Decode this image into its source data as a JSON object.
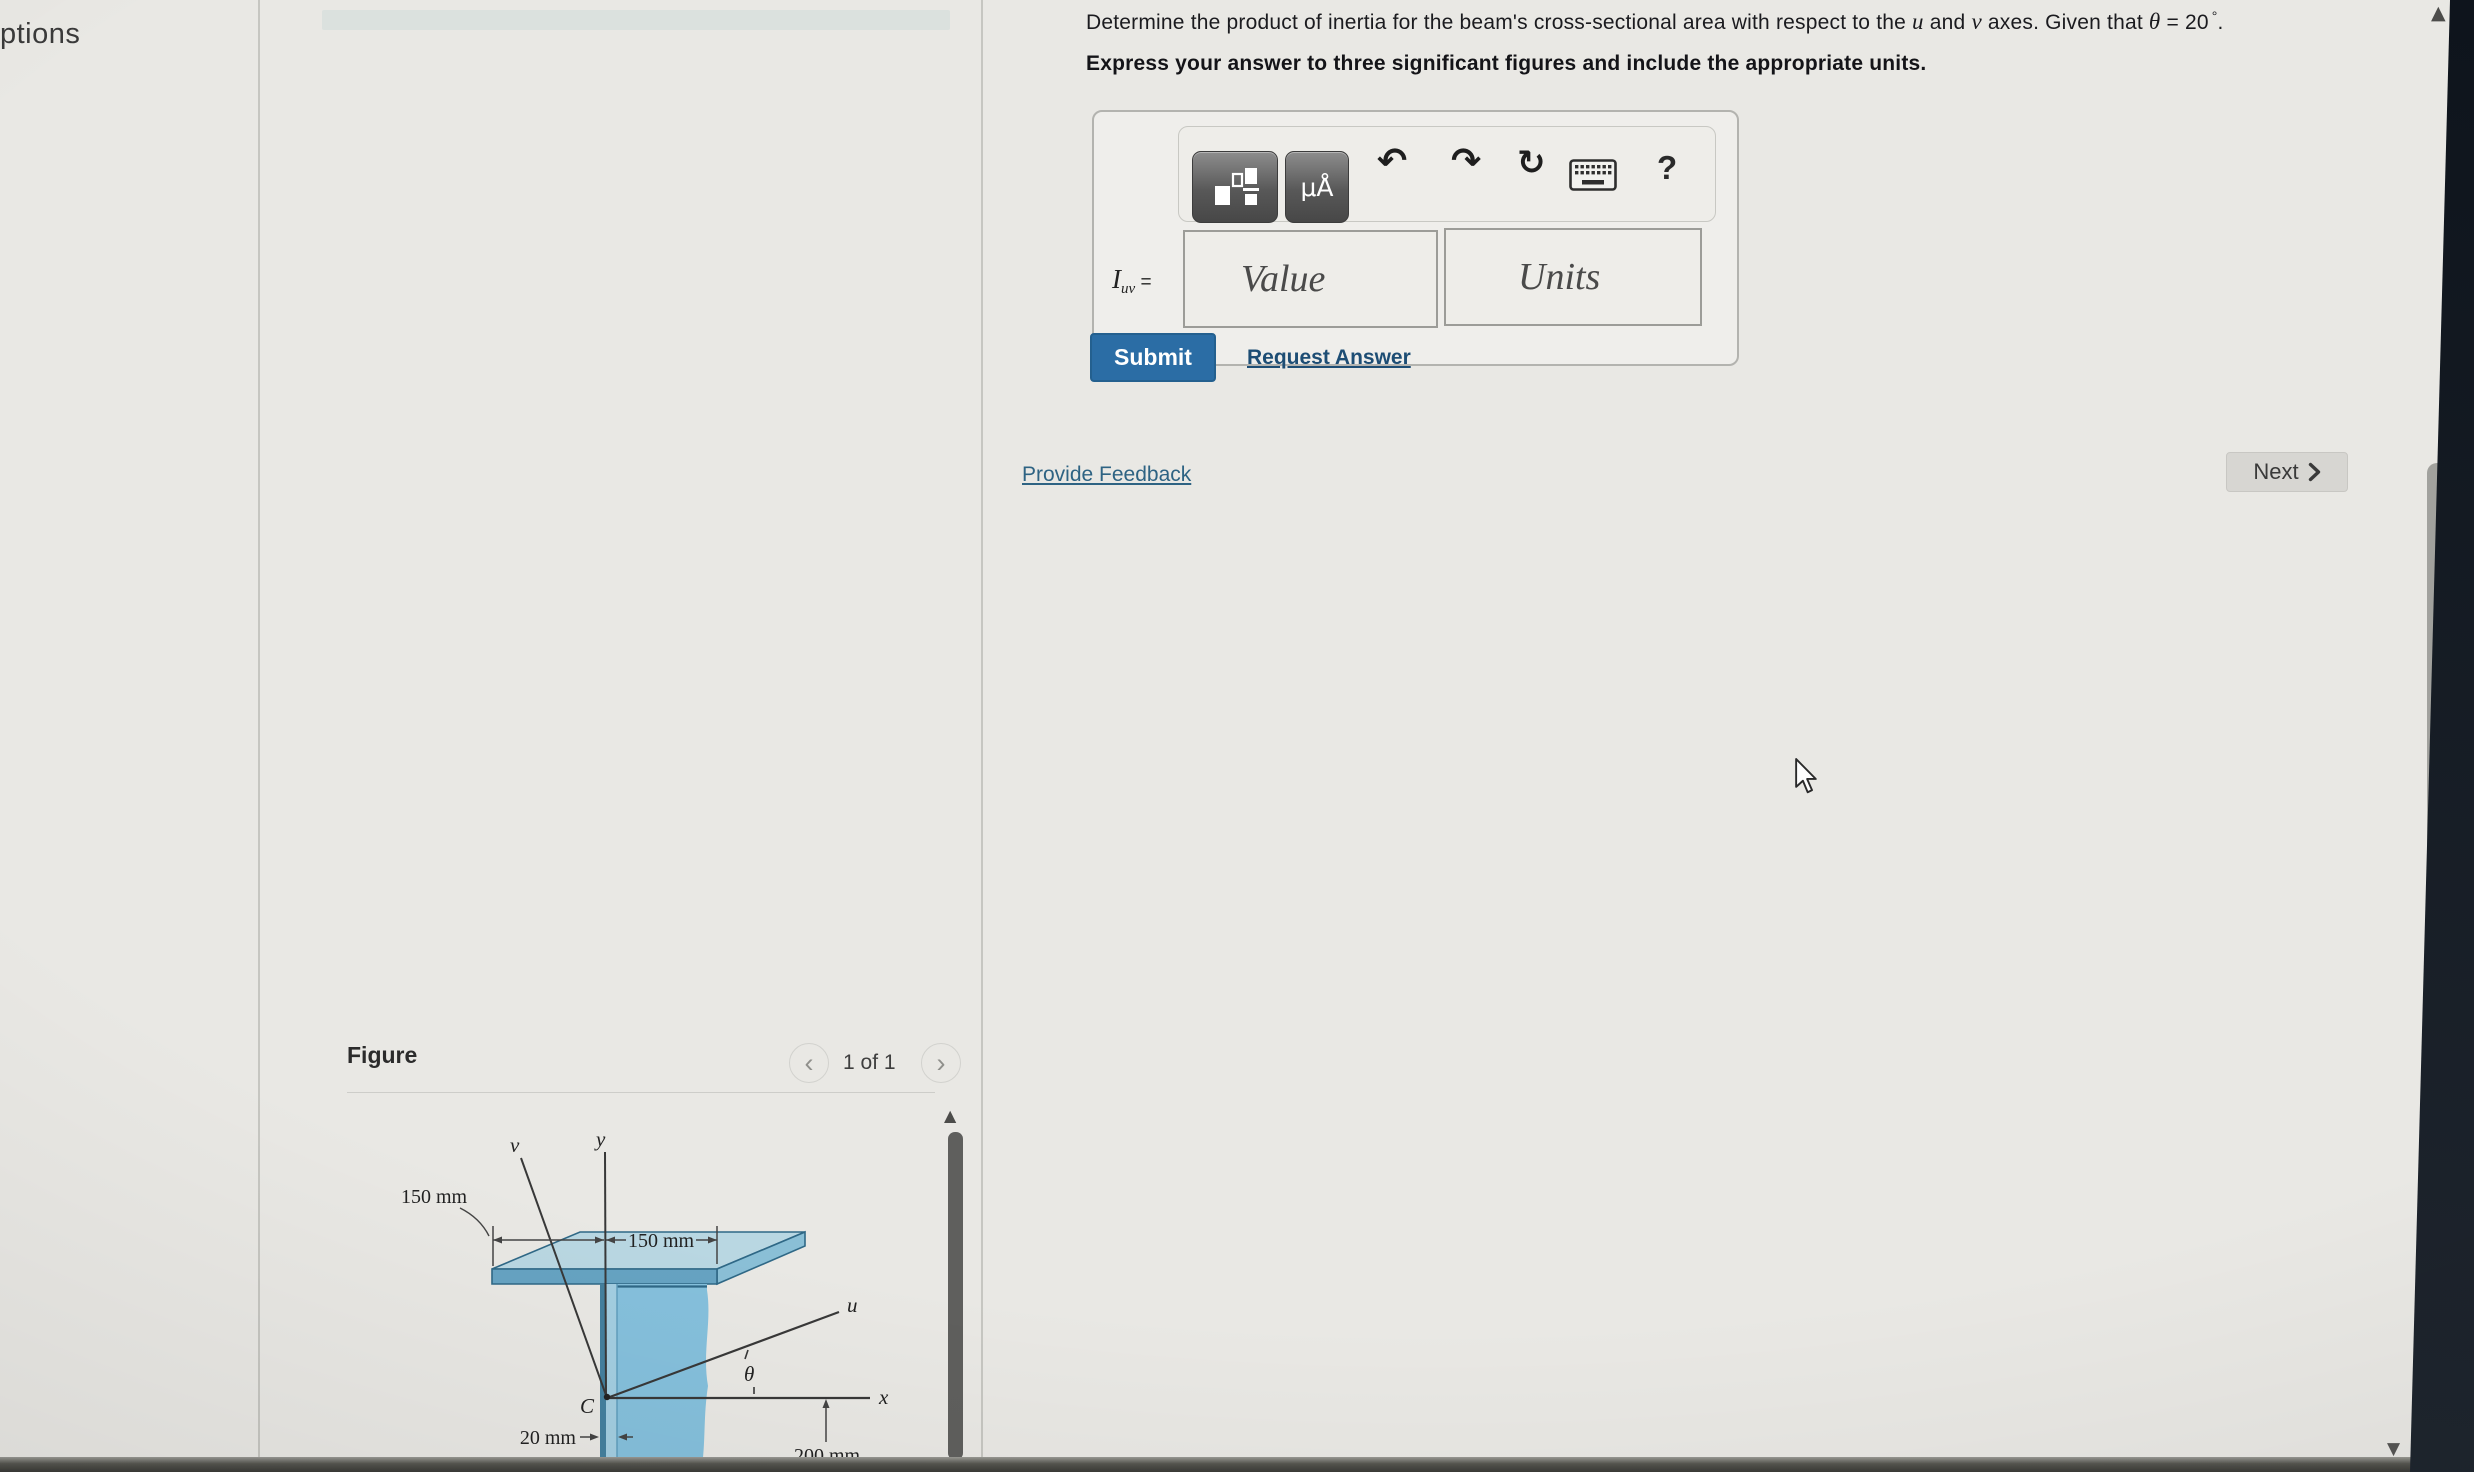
{
  "window": {
    "partial_left_label": "ptions"
  },
  "problem": {
    "statement": {
      "p1": "Determine the product of inertia for the beam's cross-sectional area with respect to the ",
      "u": "u",
      "p2": " and ",
      "v": "v",
      "p3": " axes. Given that ",
      "theta": "θ",
      "p4": " = 20",
      "degree": "°",
      "p5": ".",
      "instruction": "Express your answer to three significant figures and include the appropriate units."
    }
  },
  "answer_box": {
    "quantity": {
      "symbol": "I",
      "subscript": "uv",
      "equals": "="
    },
    "value_placeholder": "Value",
    "units_placeholder": "Units",
    "toolbar": {
      "units_icon_label": "μÅ",
      "undo_glyph": "↶",
      "redo_glyph": "↷",
      "reset_glyph": "↻",
      "help_label": "?"
    }
  },
  "actions": {
    "submit_label": "Submit",
    "request_answer_label": "Request Answer"
  },
  "links": {
    "provide_feedback_label": "Provide Feedback"
  },
  "pager": {
    "next_label": "Next"
  },
  "figure_panel": {
    "title": "Figure",
    "pagination": "1 of 1",
    "prev_glyph": "‹",
    "next_glyph": "›"
  },
  "figure": {
    "axes": {
      "x": "x",
      "y": "y",
      "u": "u",
      "v": "v"
    },
    "centroid": "C",
    "angle": "θ",
    "dimensions": {
      "flange_left": "150 mm",
      "flange_right": "150 mm",
      "web_thickness": "20 mm",
      "web_depth": "200 mm"
    }
  },
  "colors": {
    "page_bg": "#e9e8e4",
    "submit_bg": "#2b6da5",
    "link_blue": "#2d5f85",
    "beam_top": "#b9d7e2",
    "beam_front": "#66a3c2",
    "beam_side": "#8abfd6",
    "beam_web_band": "#85c0dc",
    "beam_web_light": "#a3cee1",
    "beam_web_edge": "#44809e",
    "beam_edge": "#2f6886"
  },
  "scrollbars": {
    "up_glyph": "▲",
    "down_glyph": "▼"
  }
}
